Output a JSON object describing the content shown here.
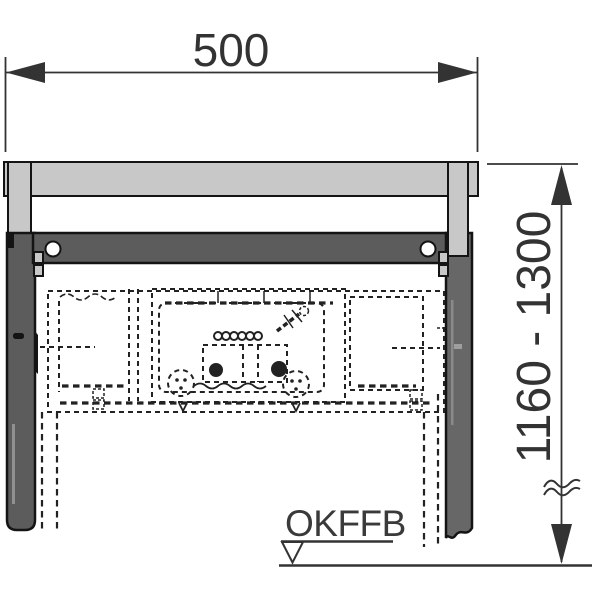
{
  "drawing": {
    "kind": "installation drawing - concealed cistern mounting frame, front view",
    "labels": {
      "width": "500",
      "height_range": "1160 - 1300",
      "floor_level": "OKFFB"
    },
    "colors": {
      "background": "#ffffff",
      "profile_light": "#c8c8c8",
      "profile_dark": "#5c5c5c",
      "profile_dark_right": "#676767",
      "outline": "#141414",
      "dashed": "#222222",
      "dimension": "#333333"
    }
  }
}
